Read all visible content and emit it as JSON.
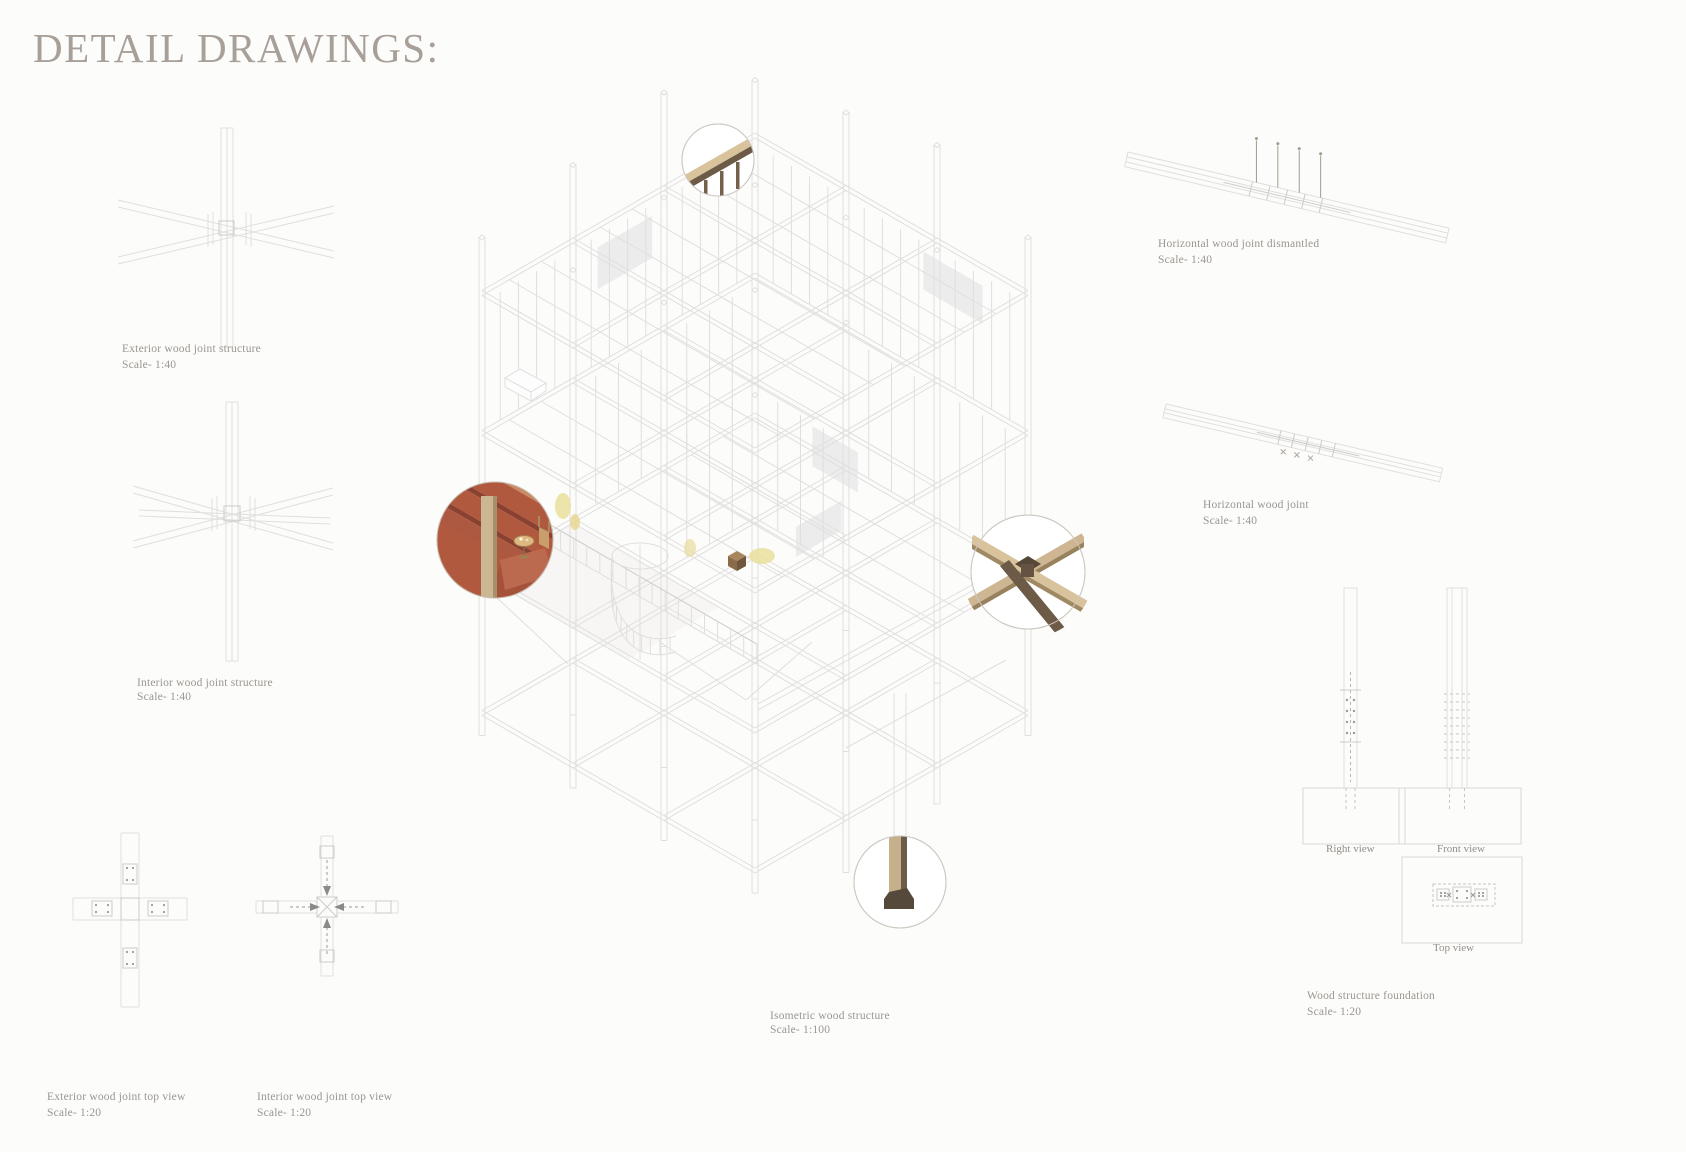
{
  "title": "DETAIL DRAWINGS:",
  "captions": {
    "exterior_joint": {
      "title": "Exterior wood joint structure",
      "scale": "Scale- 1:40"
    },
    "interior_joint": {
      "title": "Interior wood joint structure",
      "scale": "Scale- 1:40"
    },
    "horizontal_dismantled": {
      "title": "Horizontal wood joint dismantled",
      "scale": "Scale- 1:40"
    },
    "horizontal_joint": {
      "title": "Horizontal wood joint",
      "scale": "Scale- 1:40"
    },
    "isometric_structure": {
      "title": "Isometric wood structure",
      "scale": "Scale- 1:100"
    },
    "exterior_top": {
      "title": "Exterior wood joint top view",
      "scale": "Scale- 1:20"
    },
    "interior_top": {
      "title": "Interior wood joint top view",
      "scale": "Scale- 1:20"
    },
    "foundation": {
      "title": "Wood structure foundation",
      "scale": "Scale- 1:20"
    }
  },
  "view_labels": {
    "right": "Right view",
    "front": "Front view",
    "top": "Top view"
  },
  "colors": {
    "line": "#e0dfde",
    "line_dark": "#cccbca",
    "text": "#9b968f",
    "title": "#a8a098",
    "wood_tan": "#d9c39c",
    "wood_tan_dark": "#a08a64",
    "wood_brown": "#6e5b47",
    "wood_brown_deep": "#55493c",
    "terracotta": "#b0593f",
    "terracotta_dark": "#8a4130",
    "terracotta_mid": "#ad5841",
    "salmon": "#c98a64",
    "column_tan": "#cdb793",
    "column_tan_edge": "#a68f69",
    "furniture_tan": "#c89f6b",
    "accent_yellow": "#eadf9e",
    "panel_gray": "#ececec"
  }
}
